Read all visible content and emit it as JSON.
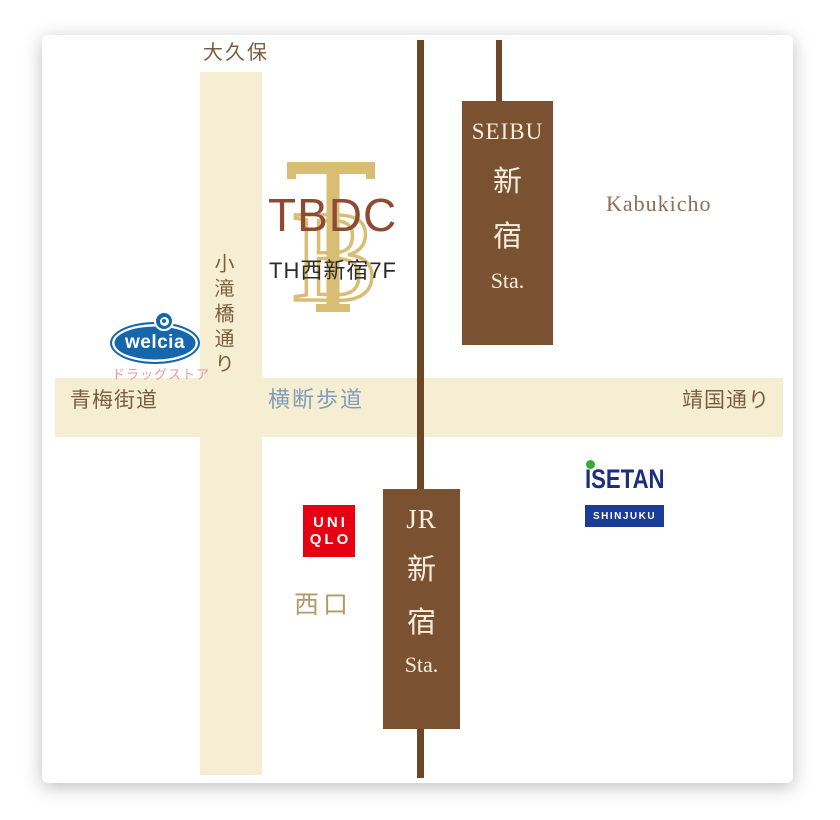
{
  "roads": {
    "okubo": "大久保",
    "kotakibashi_dori": "小滝橋通り",
    "ome_kaido": "青梅街道",
    "crosswalk": "横断歩道",
    "yasukuni_dori": "靖国通り"
  },
  "areas": {
    "kabukicho": "Kabukicho",
    "west_exit": "西口"
  },
  "tbdc": {
    "monogram_b": "B",
    "name": "TBDC",
    "address": "TH西新宿7F"
  },
  "stations": {
    "seibu": {
      "lines": [
        "SEIBU",
        "新",
        "宿",
        "Sta."
      ]
    },
    "jr": {
      "lines": [
        "JR",
        "新",
        "宿",
        "Sta."
      ]
    }
  },
  "landmarks": {
    "welcia": {
      "name": "welcia",
      "subtitle": "ドラッグストア"
    },
    "uniqlo": {
      "line1": "UNI",
      "line2": "QLO"
    },
    "isetan": {
      "name": "ISETAN",
      "badge": "SHINJUKU"
    }
  },
  "colors": {
    "road_cream": "#f6eed2",
    "rail_brown": "#6d4626",
    "station_brown": "#7a5231",
    "station_text": "#f6eedd",
    "label_brown": "#7c5c41",
    "kabukicho_brown": "#8c6e58",
    "crosswalk_blue": "#7f9cb8",
    "west_exit_tan": "#b49a68",
    "tbdc_gold": "#d9bd72",
    "tbdc_brown": "#8e4a34",
    "welcia_blue": "#1566ad",
    "welcia_pink": "#ee97a8",
    "uniqlo_red": "#e60012",
    "isetan_navy": "#1b2e80",
    "isetan_badge_navy": "#1a3c96",
    "isetan_green": "#3aaa35"
  }
}
